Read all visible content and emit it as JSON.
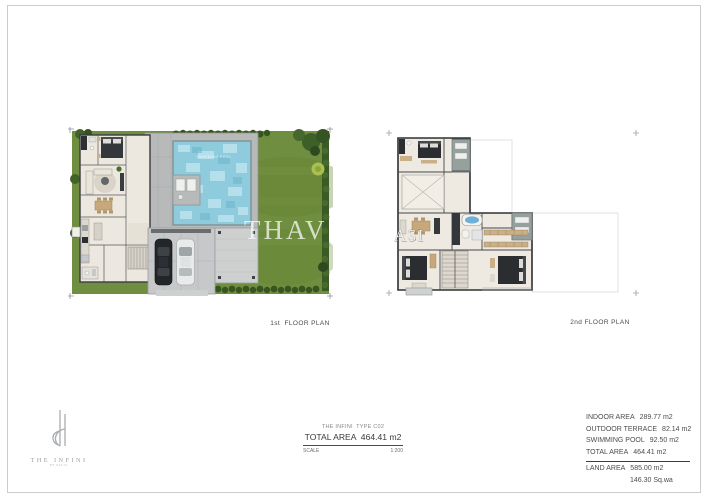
{
  "plans": {
    "first": {
      "caption": "1st  FLOOR PLAN",
      "watermark": "THAV",
      "pool_label": "SWIMMING POOL"
    },
    "second": {
      "caption": "2nd FLOOR PLAN",
      "watermark": "ASI"
    }
  },
  "title_block": {
    "project_line": "THE INFINI  TYPE C02",
    "total_area_line": "TOTAL AREA  464.41 m2",
    "scale_label": "SCALE",
    "scale_value": "1:200"
  },
  "area_summary": {
    "rows": [
      {
        "label": "INDOOR AREA",
        "value": "289.77 m2"
      },
      {
        "label": "OUTDOOR TERRACE",
        "value": "82.14 m2"
      },
      {
        "label": "SWIMMING POOL",
        "value": "92.50 m2"
      },
      {
        "label": "TOTAL AREA",
        "value": "464.41 m2"
      }
    ],
    "land_row": {
      "label": "LAND AREA",
      "value": "585.00 m2"
    },
    "land_sub": "146.30 Sq.wa"
  },
  "logo": {
    "brand": "THE INFINI",
    "tagline": "BY PATTA"
  },
  "colors": {
    "garden_green": "#6f8e3f",
    "hedge_green": "#3a5a26",
    "pool_blue": "#8ecbdd",
    "pool_deck_gray": "#b7bab9",
    "terrace_gray": "#96a09c",
    "floor_tone": "#eeeae1",
    "wall_dark": "#2f3033",
    "text_dark": "#3a3a3a",
    "text_gray": "#8a8a8a"
  }
}
